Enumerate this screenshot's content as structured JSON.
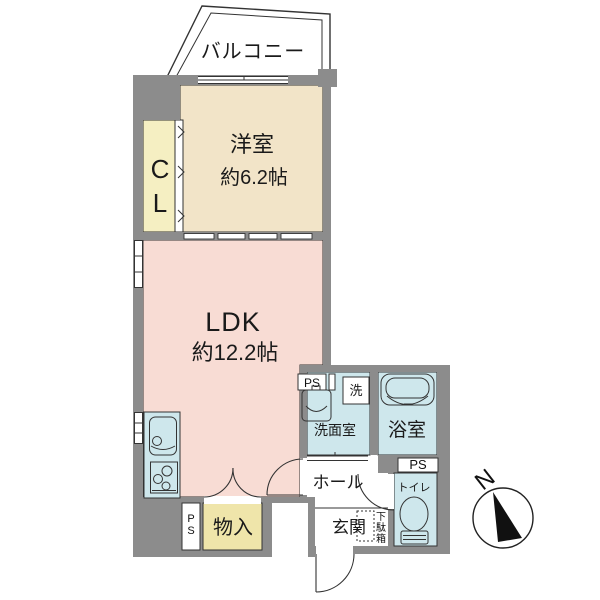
{
  "plan": {
    "balcony": "バルコニー",
    "closet_char_top": "C",
    "closet_char_bottom": "L",
    "western_room_name": "洋室",
    "western_room_size": "約6.2帖",
    "ldk_name": "LDK",
    "ldk_size": "約12.2帖",
    "washroom": "洗面室",
    "washer": "洗",
    "bathroom": "浴室",
    "toilet": "トイレ",
    "hall": "ホール",
    "entrance": "玄関",
    "shoe_box_chars": [
      "下",
      "駄",
      "箱"
    ],
    "storage": "物入",
    "ps_top": "PS",
    "ps_right": "PS",
    "ps_chars": [
      "P",
      "S"
    ],
    "compass_north": "N",
    "colors": {
      "wall": "#8C8C8C",
      "western_room": "#F2E4C8",
      "ldk": "#F8DCD4",
      "closet": "#F5EFC2",
      "storage": "#EFE5AA",
      "water_rooms": "#CEE7EC",
      "outline": "#222222"
    }
  }
}
